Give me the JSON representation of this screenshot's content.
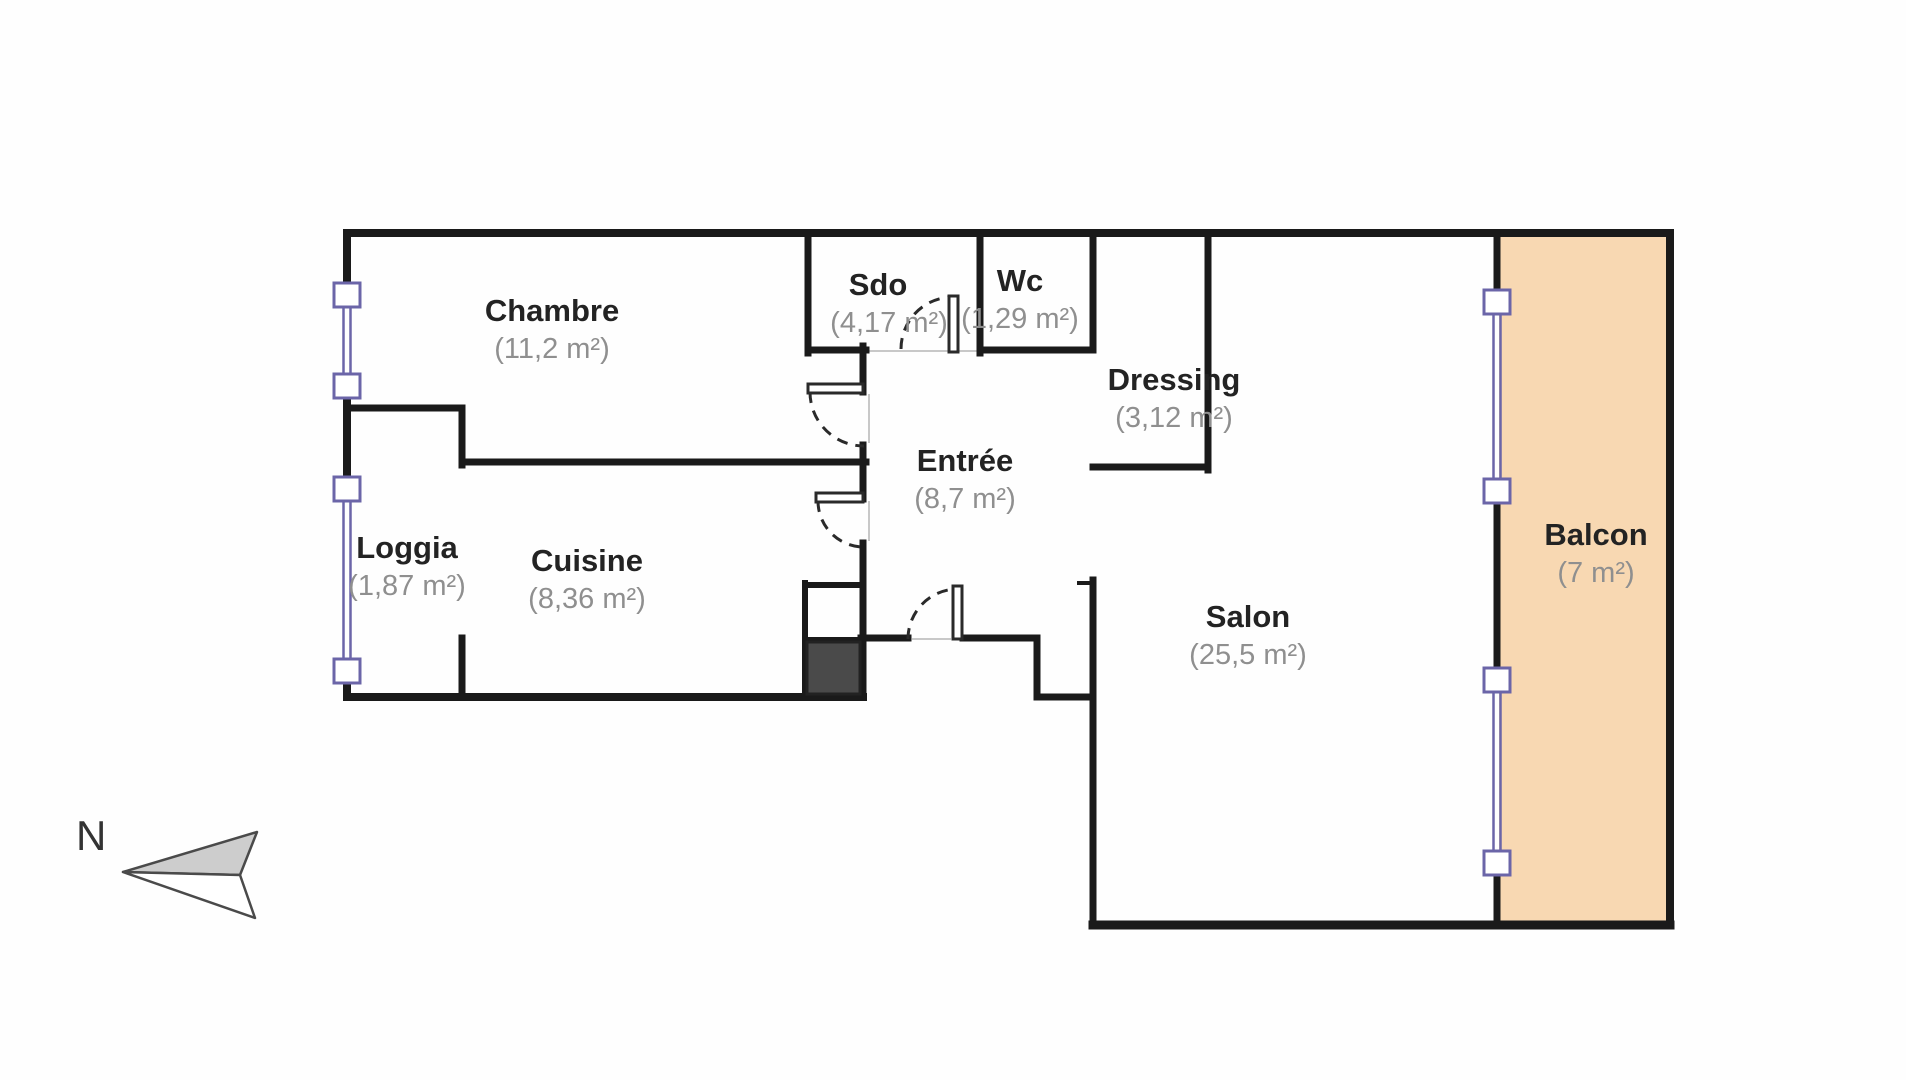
{
  "plan_title": "Apartment floor plan",
  "compass": {
    "label": "N"
  },
  "rooms": [
    {
      "name": "Chambre",
      "area": "(11,2 m²)"
    },
    {
      "name": "Sdo",
      "area": "(4,17 m²)"
    },
    {
      "name": "Wc",
      "area": "(1,29 m²)"
    },
    {
      "name": "Dressing",
      "area": "(3,12 m²)"
    },
    {
      "name": "Entrée",
      "area": "(8,7 m²)"
    },
    {
      "name": "Loggia",
      "area": "(1,87 m²)"
    },
    {
      "name": "Cuisine",
      "area": "(8,36 m²)"
    },
    {
      "name": "Salon",
      "area": "(25,5 m²)"
    },
    {
      "name": "Balcon",
      "area": "(7 m²)"
    }
  ],
  "colors": {
    "wall": "#1a1a1a",
    "balcony_fill": "#f8d8b2",
    "window": "#6b65a8",
    "room_name_text": "#232323",
    "area_text": "#8f8f8f",
    "duct_fill": "#4a4a4a",
    "arrow_fill": "#cdcdcd"
  }
}
